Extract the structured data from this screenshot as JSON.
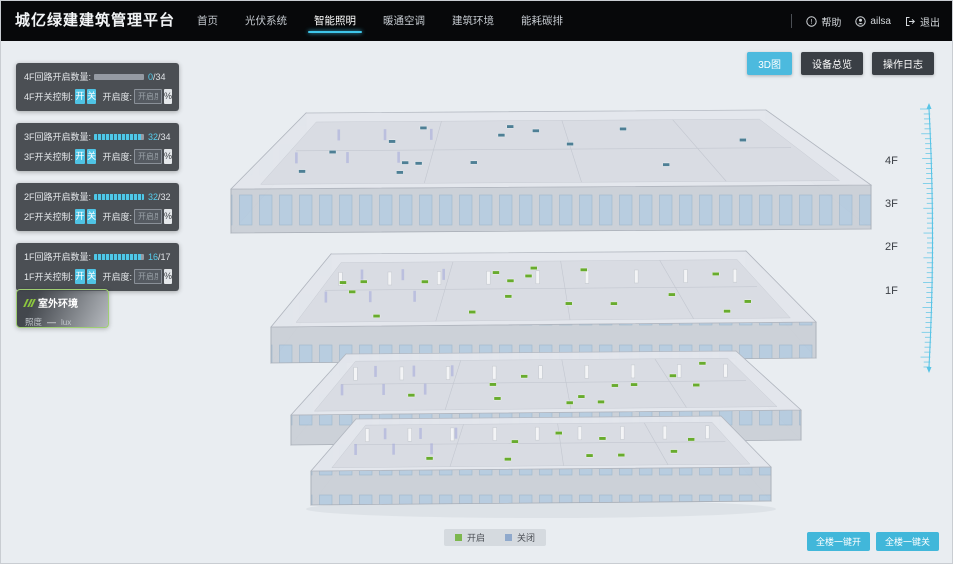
{
  "header": {
    "brand": "城亿绿建建筑管理平台",
    "nav": [
      {
        "label": "首页",
        "active": false
      },
      {
        "label": "光伏系统",
        "active": false
      },
      {
        "label": "智能照明",
        "active": true
      },
      {
        "label": "暖通空调",
        "active": false
      },
      {
        "label": "建筑环境",
        "active": false
      },
      {
        "label": "能耗碳排",
        "active": false
      }
    ],
    "help_label": "帮助",
    "username": "ailsa",
    "logout_label": "退出"
  },
  "toolbar": {
    "view_3d": "3D图",
    "device_overview": "设备总览",
    "operation_log": "操作日志"
  },
  "floor_panels": [
    {
      "floor": "4F",
      "count_label": "4F回路开启数量:",
      "count_value": "0",
      "count_total": "/34",
      "pct": 0,
      "switch_label": "4F开关控制:",
      "on_label": "开",
      "off_label": "关",
      "dim_label": "开启度:",
      "dim_placeholder": "开启度",
      "percent_label": "%"
    },
    {
      "floor": "3F",
      "count_label": "3F回路开启数量:",
      "count_value": "32",
      "count_total": "/34",
      "pct": 94,
      "switch_label": "3F开关控制:",
      "on_label": "开",
      "off_label": "关",
      "dim_label": "开启度:",
      "dim_placeholder": "开启度",
      "percent_label": "%"
    },
    {
      "floor": "2F",
      "count_label": "2F回路开启数量:",
      "count_value": "32",
      "count_total": "/32",
      "pct": 100,
      "switch_label": "2F开关控制:",
      "on_label": "开",
      "off_label": "关",
      "dim_label": "开启度:",
      "dim_placeholder": "开启度",
      "percent_label": "%"
    },
    {
      "floor": "1F",
      "count_label": "1F回路开启数量:",
      "count_value": "16",
      "count_total": "/17",
      "pct": 94,
      "switch_label": "1F开关控制:",
      "on_label": "开",
      "off_label": "关",
      "dim_label": "开启度:",
      "dim_placeholder": "开启度",
      "percent_label": "%"
    }
  ],
  "outdoor_panel": {
    "title": "室外环境",
    "metric_label": "照度",
    "metric_value": "—",
    "metric_unit": "lux"
  },
  "floor_labels": [
    {
      "label": "4F"
    },
    {
      "label": "3F"
    },
    {
      "label": "2F"
    },
    {
      "label": "1F"
    }
  ],
  "legend": {
    "on_label": "开启",
    "on_color": "#7cb74e",
    "off_label": "关闭",
    "off_color": "#8fa9cc"
  },
  "bulk_actions": {
    "all_on": "全楼一键开",
    "all_off": "全楼一键关"
  },
  "building": {
    "floors": [
      {
        "name": "4F",
        "marker_color": "#4e7f95",
        "marker_count": 15
      },
      {
        "name": "3F",
        "marker_color": "#68ab2e",
        "marker_count": 18
      },
      {
        "name": "2F",
        "marker_color": "#68ab2e",
        "marker_count": 12
      },
      {
        "name": "1F",
        "marker_color": "#68ab2e",
        "marker_count": 9
      }
    ]
  },
  "colors": {
    "accent": "#4cbade"
  }
}
